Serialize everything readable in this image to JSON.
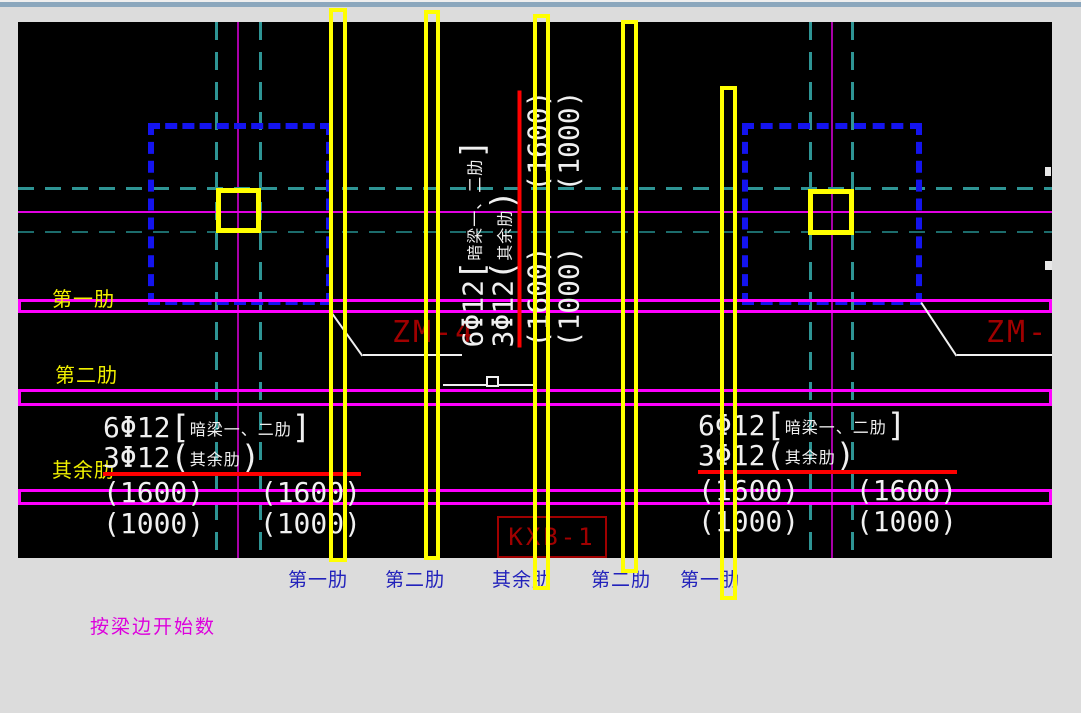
{
  "window": {
    "top_strip_color": "#8BA7BD"
  },
  "colors": {
    "canvas_bg": "#000000",
    "page_bg": "#DCDCDC",
    "grid_teal": "#2E9494",
    "grid_magenta": "#A800A8",
    "axis_magenta": "#E000E0",
    "band_magenta": "#FF00FF",
    "highlight_yellow": "#FFFF00",
    "column_blue": "#1414EE",
    "rebar_red": "#FF0000",
    "tag_dark_red": "#A00000",
    "text_white": "#F0F0F0",
    "label_yellow": "#F0F000",
    "label_blue": "#2222BB",
    "note_magenta": "#DD00DD"
  },
  "labels": {
    "left": [
      "第一肋",
      "第二肋",
      "其余肋"
    ],
    "bottom": [
      "第一肋",
      "第二肋",
      "其余肋",
      "第二肋",
      "第一肋"
    ],
    "note": "按梁边开始数"
  },
  "tags": {
    "zm_left": "ZM-4",
    "zm_right": "ZM-",
    "slab": "KXB-1"
  },
  "rebar_note": {
    "qty_main": "6Φ12",
    "open_bracket": "[",
    "scope_main": "暗梁一、二肋",
    "close_bracket": "]",
    "qty_rest": "3Φ12",
    "open_paren": "(",
    "scope_rest": "其余肋",
    "close_paren": ")",
    "dim_upper": "(1600)",
    "dim_lower": "(1000)"
  }
}
